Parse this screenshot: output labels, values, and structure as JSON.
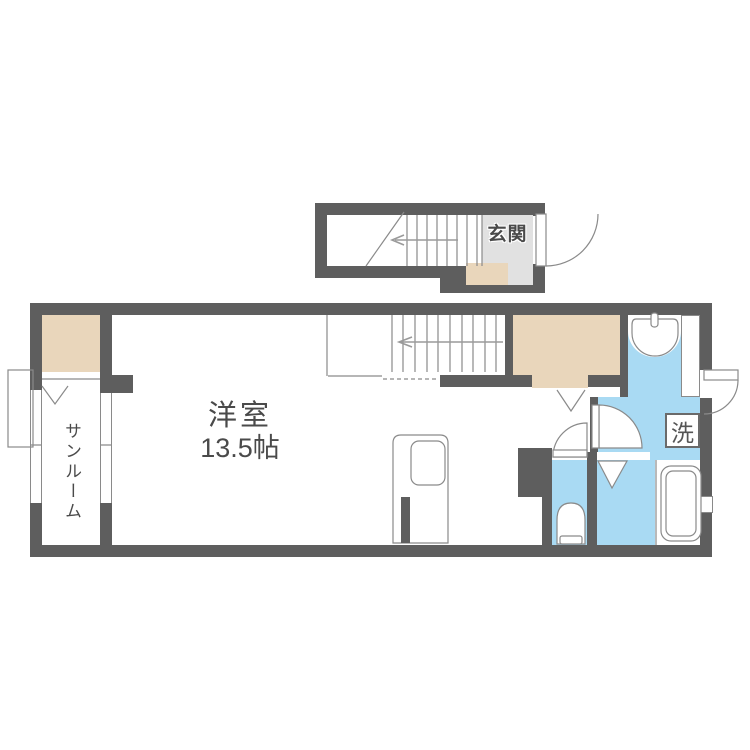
{
  "document_type": "apartment-floor-plan",
  "labels": {
    "entrance": "玄関",
    "main_room": "洋室",
    "main_room_size": "13.5帖",
    "sunroom": "サンルーム",
    "laundry": "洗"
  },
  "colors": {
    "wall": "#5e5e5e",
    "closet": "#e9d6bb",
    "genkan": "#e1e1e1",
    "wet": "#a9daf3",
    "line": "#8a8a8a",
    "text": "#4a4a4a"
  },
  "fixtures": [
    "upper-staircase",
    "main-staircase",
    "entrance-door",
    "side-exterior-door",
    "washbasin",
    "washing-machine-space",
    "toilet",
    "bathtub",
    "kitchen-unit",
    "sunroom-windows",
    "bay-window",
    "closet-folding-doors",
    "shower-folding-door"
  ]
}
